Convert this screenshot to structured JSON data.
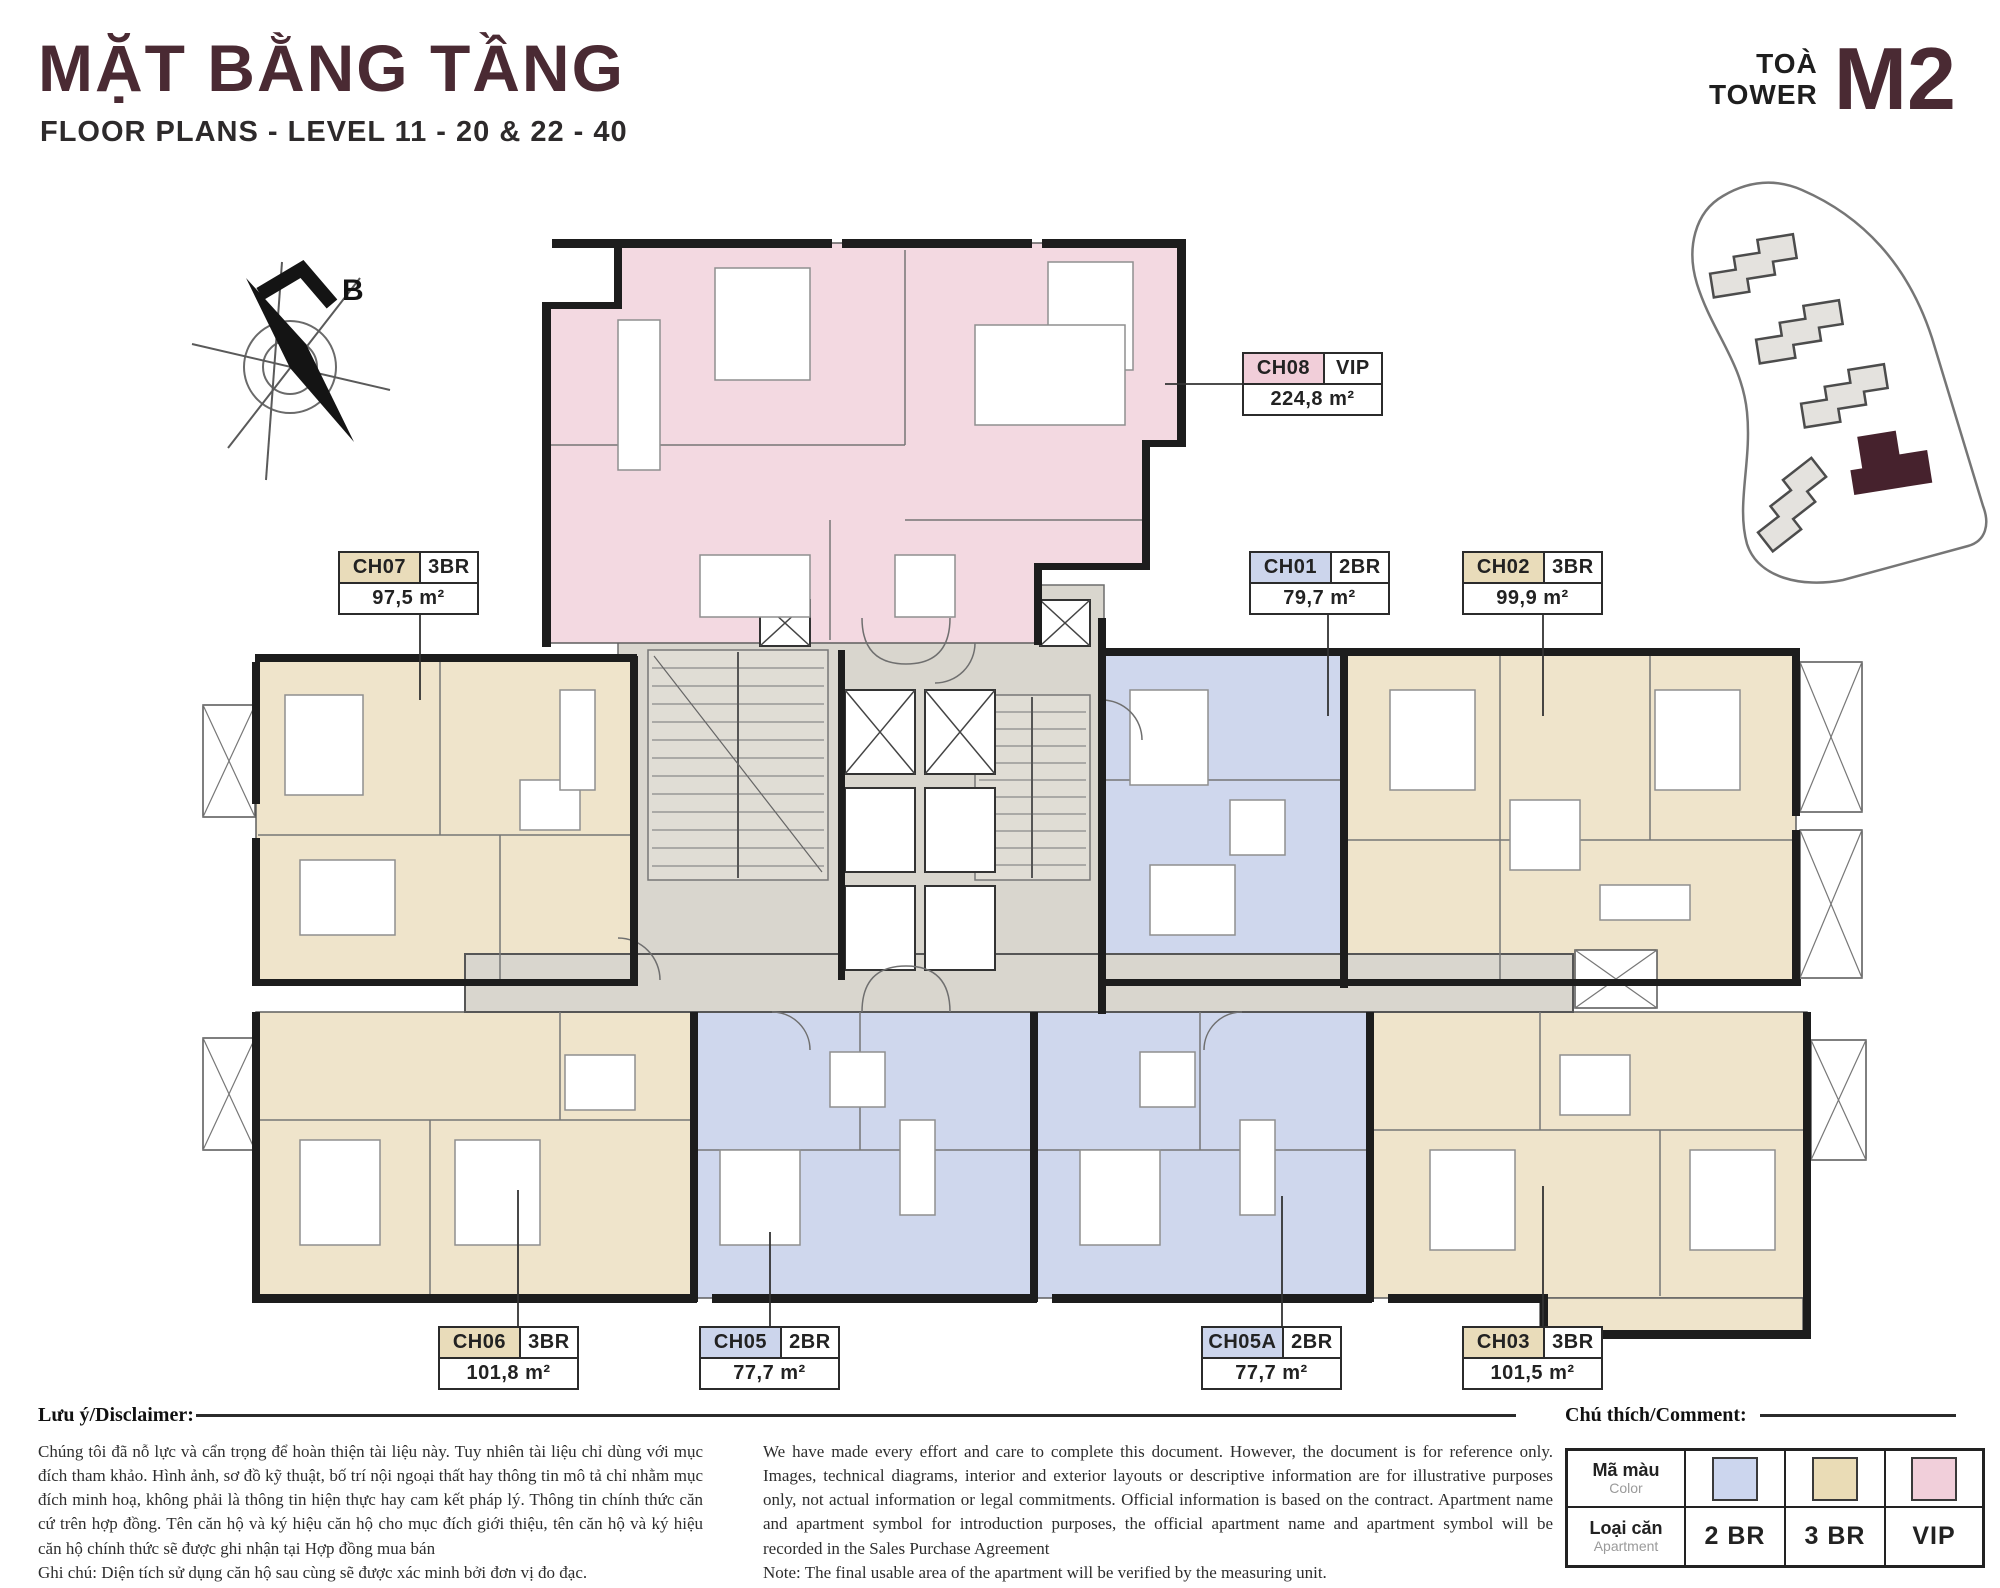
{
  "header": {
    "title": "MẶT BẰNG TẦNG",
    "subtitle": "FLOOR PLANS - LEVEL 11 - 20 & 22 - 40",
    "tower_word_vi": "TOÀ",
    "tower_word_en": "TOWER",
    "tower_code": "M2"
  },
  "compass": {
    "north_label": "B"
  },
  "apartments": [
    {
      "id": "CH08",
      "type": "VIP",
      "area": "224,8 m²",
      "category": "vip"
    },
    {
      "id": "CH07",
      "type": "3BR",
      "area": "97,5 m²",
      "category": "3br"
    },
    {
      "id": "CH01",
      "type": "2BR",
      "area": "79,7 m²",
      "category": "2br"
    },
    {
      "id": "CH02",
      "type": "3BR",
      "area": "99,9 m²",
      "category": "3br"
    },
    {
      "id": "CH06",
      "type": "3BR",
      "area": "101,8 m²",
      "category": "3br"
    },
    {
      "id": "CH05",
      "type": "2BR",
      "area": "77,7 m²",
      "category": "2br"
    },
    {
      "id": "CH05A",
      "type": "2BR",
      "area": "77,7 m²",
      "category": "2br"
    },
    {
      "id": "CH03",
      "type": "3BR",
      "area": "101,5 m²",
      "category": "3br"
    }
  ],
  "disclaimer": {
    "heading": "Lưu ý/Disclaimer:",
    "vietnamese": "Chúng tôi đã nỗ lực và cẩn trọng để hoàn thiện tài liệu này. Tuy nhiên tài liệu chỉ dùng với mục đích tham khảo. Hình ảnh, sơ đồ kỹ thuật, bố trí nội ngoại thất hay thông tin mô tả chỉ nhằm mục đích minh hoạ, không phải là thông tin hiện thực hay cam kết pháp lý. Thông tin chính thức căn cứ trên hợp đồng. Tên căn hộ và ký hiệu căn hộ cho mục đích giới thiệu, tên căn hộ và ký hiệu căn hộ chính thức sẽ được ghi nhận tại Hợp đồng mua bán",
    "vietnamese_note": "Ghi chú: Diện tích sử dụng căn hộ sau cùng sẽ được xác minh bởi đơn vị đo đạc.",
    "english": "We have made every effort and care to complete this document. However, the document is for reference only. Images, technical diagrams, interior and exterior layouts or descriptive information are for illustrative purposes only, not actual information or legal commitments. Official information is based on the contract. Apartment name and apartment symbol for introduction purposes, the official apartment name and apartment symbol will be recorded in the Sales Purchase Agreement",
    "english_note": "Note: The final usable area of the apartment will be verified by the measuring unit."
  },
  "legend": {
    "heading": "Chú thích/Comment:",
    "color_row_label_vi": "Mã màu",
    "color_row_label_en": "Color",
    "type_row_label_vi": "Loại căn",
    "type_row_label_en": "Apartment",
    "entries": [
      {
        "label": "2 BR",
        "color": "#ccd6ee"
      },
      {
        "label": "3 BR",
        "color": "#eadcb6"
      },
      {
        "label": "VIP",
        "color": "#f1cfda"
      }
    ]
  },
  "colors": {
    "accent_maroon": "#4a2a33",
    "apartment_2br": "#cfd7ed",
    "apartment_3br": "#efe4cb",
    "apartment_vip": "#f3d9e1",
    "core_gray": "#d9d6ce",
    "wall": "#1d1d1d"
  }
}
